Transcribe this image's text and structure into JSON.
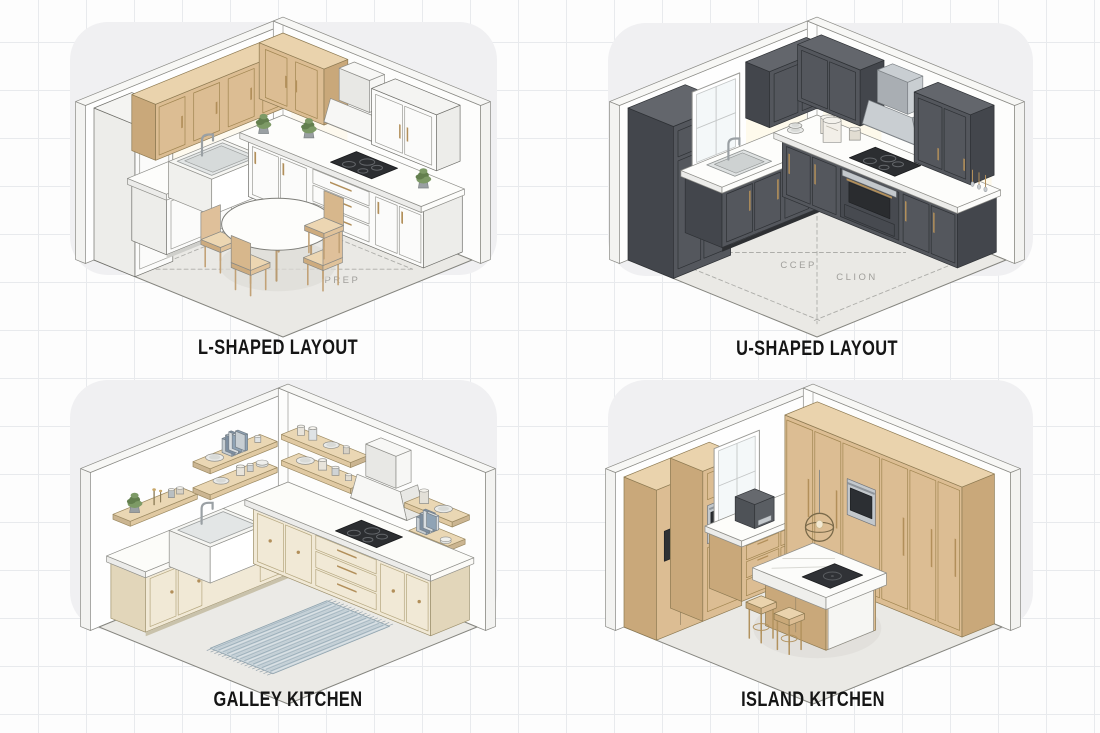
{
  "figure": {
    "title": "Kitchen layout types illustration"
  },
  "panels": [
    {
      "id": "l-shaped",
      "label": "L-SHAPED LAYOUT",
      "floor_labels": [
        "PREP"
      ]
    },
    {
      "id": "u-shaped",
      "label": "U-SHAPED LAYOUT",
      "floor_labels": [
        "CCEP",
        "CLION"
      ]
    },
    {
      "id": "galley",
      "label": "GALLEY KITCHEN",
      "floor_labels": []
    },
    {
      "id": "island",
      "label": "ISLAND KITCHEN",
      "floor_labels": []
    }
  ],
  "colors": {
    "wood": "#dcbd93",
    "woodSide": "#c9a87a",
    "woodTop": "#ead3ad",
    "woodLine": "#a08550",
    "cream": "#f1e9d6",
    "creamSide": "#e2d6ba",
    "creamTop": "#f6f0e0",
    "creamLine": "#b5a77f",
    "dark": "#54575d",
    "darkSide": "#43464c",
    "darkTop": "#63666c",
    "darkLine": "#2e3135",
    "white": "#fbfbfa",
    "whiteSide": "#ededea",
    "whiteTop": "#f4f4f2",
    "whiteLine": "#9b9b96",
    "counterTop": "#fcfcfa",
    "counterSide": "#ececea",
    "brass": "#b28f5a",
    "steel": "#c3c8cc",
    "steelDark": "#8d9296",
    "black": "#2c2e31",
    "line": "#6f6f6a",
    "floor": "#eae9e5",
    "floorLine": "#85857f",
    "green": "#7d9a66",
    "greenDark": "#637f4e",
    "rug": "#ccd6db",
    "rugA": "#a9bac4",
    "rugB": "#dbe2e6",
    "rugLine": "#8fa3ae",
    "glow": "#fdf6df",
    "dash": "#adada9",
    "zoneText": "#a09f9b"
  }
}
